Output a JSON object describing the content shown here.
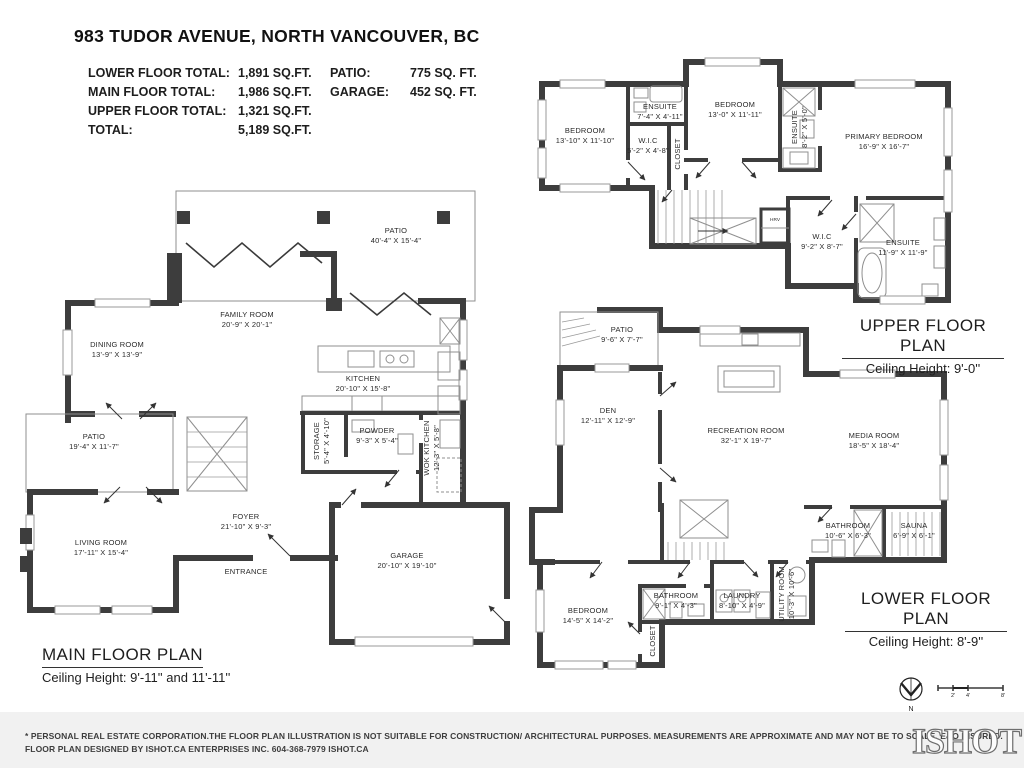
{
  "header": {
    "title": "983 TUDOR AVENUE, NORTH VANCOUVER, BC",
    "stats": [
      {
        "label": "LOWER FLOOR TOTAL:",
        "value": "1,891 SQ.FT."
      },
      {
        "label": "MAIN FLOOR TOTAL:",
        "value": "1,986 SQ.FT."
      },
      {
        "label": "UPPER FLOOR TOTAL:",
        "value": "1,321 SQ.FT."
      },
      {
        "label": "TOTAL:",
        "value": "5,189 SQ.FT."
      }
    ],
    "stats2": [
      {
        "label": "PATIO:",
        "value": "775 SQ. FT."
      },
      {
        "label": "GARAGE:",
        "value": "452 SQ. FT."
      }
    ]
  },
  "plans": {
    "main": {
      "title": "MAIN FLOOR PLAN",
      "ceiling": "Ceiling Height: 9'-11'' and 11'-11''",
      "rooms": [
        {
          "name": "PATIO",
          "dims": "40'-4\" X 15'-4\""
        },
        {
          "name": "FAMILY ROOM",
          "dims": "20'-9\" X 20'-1\""
        },
        {
          "name": "DINING ROOM",
          "dims": "13'-9\" X 13'-9\""
        },
        {
          "name": "KITCHEN",
          "dims": "20'-10\" X 15'-8\""
        },
        {
          "name": "PATIO",
          "dims": "19'-4\" X 11'-7\""
        },
        {
          "name": "STORAGE",
          "dims": "5'-4\" X 4'-10\""
        },
        {
          "name": "POWDER",
          "dims": "9'-3\" X 5'-4\""
        },
        {
          "name": "WOK KITCHEN",
          "dims": "12'-3\" X 5'-8\""
        },
        {
          "name": "FOYER",
          "dims": "21'-10\" X 9'-3\""
        },
        {
          "name": "LIVING ROOM",
          "dims": "17'-11\" X 15'-4\""
        },
        {
          "name": "ENTRANCE",
          "dims": ""
        },
        {
          "name": "GARAGE",
          "dims": "20'-10\" X 19'-10\""
        }
      ]
    },
    "upper": {
      "title": "UPPER FLOOR PLAN",
      "ceiling": "Ceiling Height: 9'-0''",
      "rooms": [
        {
          "name": "BEDROOM",
          "dims": "13'-10\" X 11'-10\""
        },
        {
          "name": "ENSUITE",
          "dims": "7'-4\" X 4'-11\""
        },
        {
          "name": "W.I.C",
          "dims": "5'-2\" X 4'-8\""
        },
        {
          "name": "CLOSET",
          "dims": ""
        },
        {
          "name": "BEDROOM",
          "dims": "13'-0\" X 11'-11\""
        },
        {
          "name": "ENSUITE",
          "dims": "8'-2\" X 5'-0\""
        },
        {
          "name": "PRIMARY BEDROOM",
          "dims": "16'-9\" X 16'-7\""
        },
        {
          "name": "W.I.C",
          "dims": "9'-2\" X 8'-7\""
        },
        {
          "name": "ENSUITE",
          "dims": "11'-9\" X 11'-9\""
        },
        {
          "name": "HRV",
          "dims": ""
        }
      ]
    },
    "lower": {
      "title": "LOWER FLOOR PLAN",
      "ceiling": "Ceiling Height: 8'-9''",
      "rooms": [
        {
          "name": "PATIO",
          "dims": "9'-6\" X 7'-7\""
        },
        {
          "name": "DEN",
          "dims": "12'-11\" X 12'-9\""
        },
        {
          "name": "RECREATION ROOM",
          "dims": "32'-1\" X 19'-7\""
        },
        {
          "name": "MEDIA ROOM",
          "dims": "18'-5\" X 18'-4\""
        },
        {
          "name": "BATHROOM",
          "dims": "10'-6\" X 6'-3\""
        },
        {
          "name": "SAUNA",
          "dims": "6'-9\" X 6'-1\""
        },
        {
          "name": "BEDROOM",
          "dims": "14'-5\" X 14'-2\""
        },
        {
          "name": "BATHROOM",
          "dims": "9'-1\" X 4'-3\""
        },
        {
          "name": "LAUNDRY",
          "dims": "8'-10\" X 4'-9\""
        },
        {
          "name": "UTILITY ROOM",
          "dims": "10'-3\" X 10'-6\""
        },
        {
          "name": "CLOSET",
          "dims": ""
        }
      ]
    }
  },
  "footer": {
    "disclaimer1": "* PERSONAL REAL ESTATE CORPORATION.THE FLOOR PLAN ILLUSTRATION IS NOT SUITABLE FOR CONSTRUCTION/ ARCHITECTURAL PURPOSES. MEASUREMENTS ARE APPROXIMATE AND MAY NOT BE TO SCALE. E&O INSURED.",
    "disclaimer2": "FLOOR PLAN DESIGNED BY ISHOT.CA ENTERPRISES INC. 604-368-7979  ISHOT.CA",
    "logo": "ISHOT",
    "compass": "N",
    "scale_marks": [
      "2'",
      "4'",
      "8'"
    ]
  },
  "colors": {
    "wall": "#3d3d3d",
    "footer_bg": "#f1f1f1",
    "text": "#1d1d1d"
  }
}
